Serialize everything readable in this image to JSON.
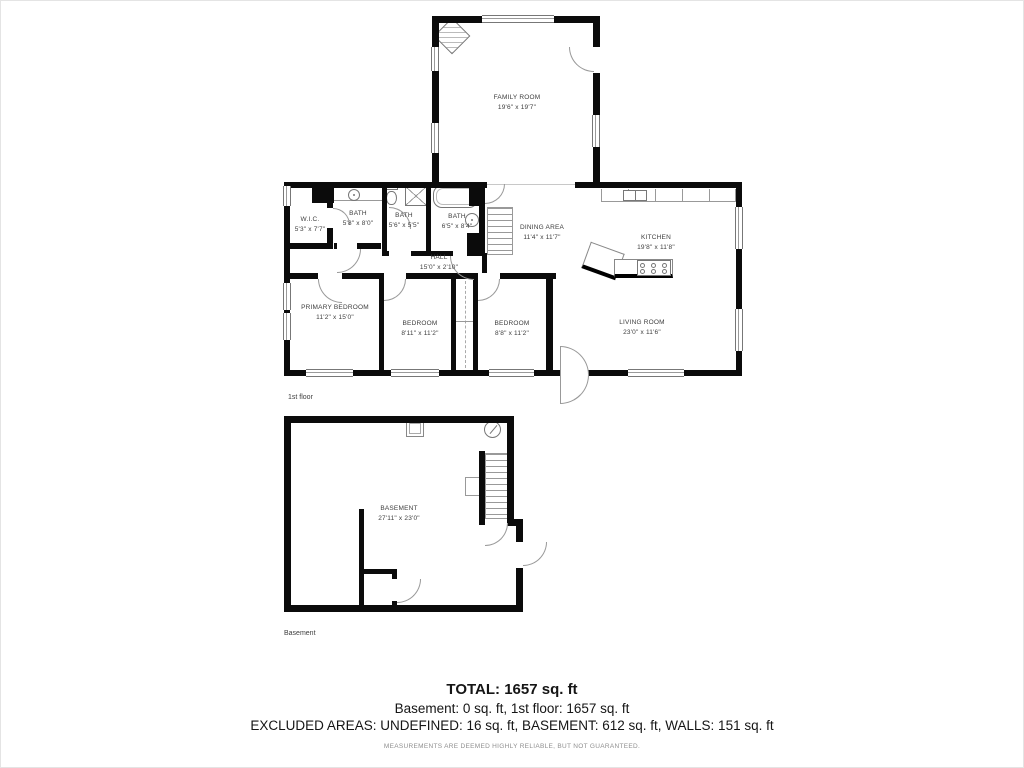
{
  "page": {
    "background": "#ffffff",
    "wall_color": "#0b0b0b"
  },
  "captions": {
    "first_floor": "1st floor",
    "basement": "Basement"
  },
  "first_floor": {
    "rooms": {
      "family": {
        "name": "FAMILY ROOM",
        "dims": "19'6\" x 19'7\""
      },
      "wic": {
        "name": "W.I.C.",
        "dims": "5'3\" x 7'7\""
      },
      "bath1": {
        "name": "BATH",
        "dims": "5'8\" x 8'0\""
      },
      "bath2": {
        "name": "BATH",
        "dims": "5'6\" x 5'5\""
      },
      "bath3": {
        "name": "BATH",
        "dims": "6'5\" x 8'4\""
      },
      "dining": {
        "name": "DINING AREA",
        "dims": "11'4\" x 11'7\""
      },
      "kitchen": {
        "name": "KITCHEN",
        "dims": "19'8\" x 11'8\""
      },
      "hall": {
        "name": "HALL",
        "dims": "15'0\" x 2'10\""
      },
      "primary": {
        "name": "PRIMARY BEDROOM",
        "dims": "11'2\" x 15'0\""
      },
      "bedroom1": {
        "name": "BEDROOM",
        "dims": "8'11\" x 11'2\""
      },
      "bedroom2": {
        "name": "BEDROOM",
        "dims": "8'8\" x 11'2\""
      },
      "living": {
        "name": "LIVING ROOM",
        "dims": "23'0\" x 11'6\""
      }
    }
  },
  "basement": {
    "rooms": {
      "basement": {
        "name": "BASEMENT",
        "dims": "27'11\" x 23'0\""
      }
    }
  },
  "summary": {
    "total": "TOTAL: 1657 sq. ft",
    "floors": "Basement: 0 sq. ft, 1st floor: 1657 sq. ft",
    "excluded": "EXCLUDED AREAS: UNDEFINED: 16 sq. ft, BASEMENT: 612 sq. ft, WALLS: 151 sq. ft",
    "disclaimer": "MEASUREMENTS ARE DEEMED HIGHLY RELIABLE, BUT NOT GUARANTEED."
  }
}
